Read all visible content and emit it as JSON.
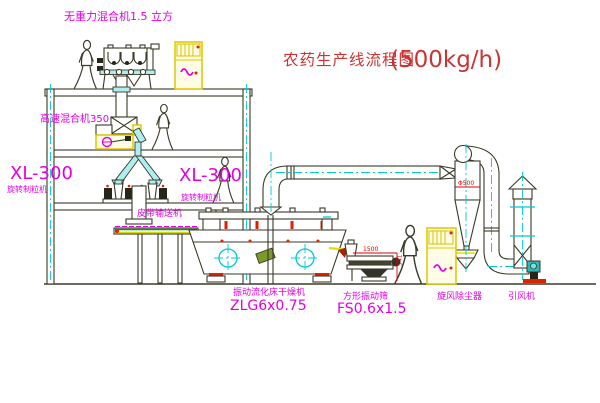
{
  "title": {
    "main": "农药生产线流程图",
    "capacity": "(500kg/h)"
  },
  "labels": {
    "gravity_mixer": "无重力混合机1.5 立方",
    "high_speed_mixer": "高速混合机350",
    "granulator_left_model": "XL-300",
    "granulator_left_name": "旋转制粒机",
    "granulator_mid_model": "XL-300",
    "granulator_mid_name": "旋转制粒机",
    "belt_conveyor": "皮带输送机",
    "fluid_bed_dryer": "振动流化床干燥机",
    "fluid_bed_dryer_model": "ZLG6x0.75",
    "square_sieve": "方形振动筛",
    "square_sieve_model": "FS0.6x1.5",
    "cyclone": "旋风除尘器",
    "fan": "引风机"
  },
  "dimensions": {
    "sieve_length": "1500",
    "sieve_height": "541",
    "cyclone_inlet": "Φ500"
  },
  "colors": {
    "label_magenta": "#e300e3",
    "title_red": "#cc3333",
    "dimension_red": "#dd0000",
    "centerline_cyan": "#00cccc",
    "cabinet_yellow": "#ddc700",
    "line_dark": "#3a3a28",
    "conveyor_green": "#00a000"
  }
}
